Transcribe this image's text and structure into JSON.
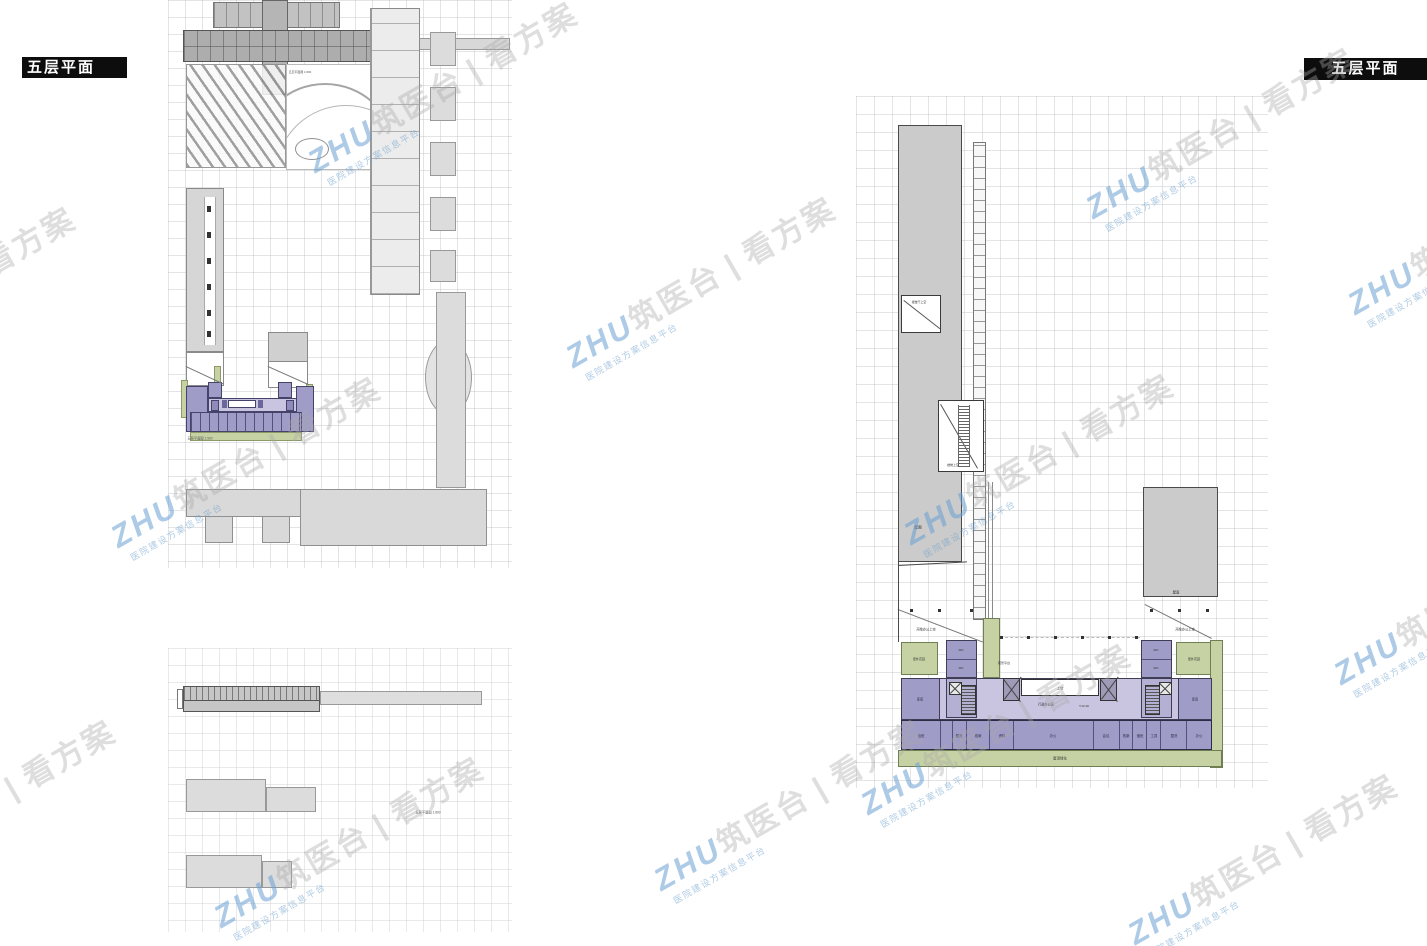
{
  "titles": {
    "left": "五层平面",
    "right": "五层平面"
  },
  "watermark": {
    "brand": "ZHU",
    "brand_cn": "筑医台",
    "separator": "|",
    "product": "看方案",
    "tagline": "医院建设方案信息平台"
  },
  "colors": {
    "accent_blue": "#6fa7d8",
    "plan_purple": "#a09cc8",
    "plan_lavender": "#c9c5e0",
    "plan_green": "#c7d2a4",
    "building_gray": "#cbcbcb"
  },
  "left_page": {
    "captions": {
      "site": "五层平面图 1:800",
      "mini": "五层平面图 1:500",
      "lower": "五层平面图 1:800"
    }
  },
  "right_plan": {
    "labels": {
      "hall_void": "报告厅上空",
      "stair_void": "楼梯上空",
      "roof_left": "屋面",
      "roof_right": "屋面",
      "open_office_left": "开敞办公上空",
      "open_office_right": "开敞办公上空",
      "garden_left": "室外花园",
      "garden_right": "室外花园",
      "platform": "观景平台",
      "green_bottom": "屋顶绿化",
      "void_center": "上空",
      "admin_zone": "行政办公区",
      "level": "12.00",
      "wc": "WC",
      "store_left": "库房",
      "store_right": "库房"
    },
    "bottom_rooms": [
      "值班",
      "",
      "盥洗",
      "档案",
      "资料",
      "办公",
      "会议",
      "档案",
      "值班",
      "工具",
      "盥洗",
      "办公"
    ]
  }
}
